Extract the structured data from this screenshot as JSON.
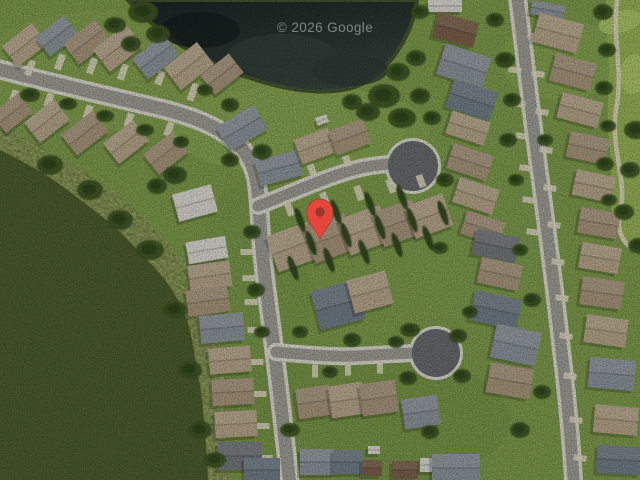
{
  "watermark": {
    "text": "© 2026 Google",
    "color": "#C9CFCE",
    "opacity": 0.55
  },
  "marker": {
    "x": 320,
    "y": 212,
    "body_color": "#E6473D",
    "edge_color": "#B5372C",
    "dot_color": "#9E372B"
  },
  "palette": {
    "grass": "#7C984B",
    "golf": "#93AF55",
    "green_oval": "#A9C368",
    "trail": "#D9D2B8",
    "pond": "#243230",
    "shore": "#43522F",
    "woods": "#4D5A2A",
    "scrub": "#6C7B3A",
    "street": "#9A9A92",
    "curb": "#D6D6CA",
    "culdesac": "#66696B",
    "driveway": "#DBD4BF",
    "tree": "#3C5323",
    "tree_dark": "#2B3E18",
    "cypress": "#2F441C",
    "roof_t": "#B3A287",
    "roof_t2": "#A5937A",
    "roof_g": "#8A9298",
    "roof_g2": "#6F7B85",
    "roof_w": "#D5D4CE",
    "roof_b": "#7A5F4A",
    "roof_gd": "#70767A"
  },
  "scene": {
    "grass_patches": [
      [
        300,
        130,
        130,
        45,
        "#8BA956",
        0.55
      ],
      [
        470,
        200,
        80,
        120,
        "#7E9C4D",
        0.4
      ],
      [
        120,
        70,
        150,
        60,
        "#86A351",
        0.4
      ],
      [
        350,
        420,
        160,
        70,
        "#6F8B42",
        0.45
      ],
      [
        250,
        300,
        60,
        120,
        "#749046",
        0.4
      ],
      [
        560,
        60,
        60,
        40,
        "#88A654",
        0.5
      ]
    ],
    "golf": {
      "area": "M 606 0 L 640 0 L 640 252 C 630 245 620 240 615 225 C 609 205 613 170 609 140 C 605 110 611 75 608 45 C 606 25 606 10 606 0 Z",
      "trail": "M 618 -4 C 611 35 624 70 616 110 C 610 148 628 180 620 215 C 616 235 626 245 636 252",
      "greens": [
        [
          620,
          22,
          22,
          11,
          -15
        ],
        [
          634,
          74,
          14,
          20,
          8
        ]
      ]
    },
    "scrub": "M 0 125 C 35 142 60 158 85 172 C 112 188 130 205 150 225 C 170 245 185 260 196 277 C 207 295 214 312 218 332 C 222 355 224 376 225 400 C 227 430 228 456 228 480 L 0 480 Z",
    "woods": "M 0 150 C 30 165 52 178 70 192 C 95 211 115 226 130 242 C 148 261 163 275 172 290 C 183 308 189 322 192 340 C 197 368 200 384 202 400 C 205 428 207 455 208 480 L 0 480 Z",
    "pond": "M 128 0 C 140 14 160 32 185 48 C 215 66 245 78 278 86 C 305 92 330 94 352 88 C 375 81 392 62 403 42 C 412 26 416 10 417 0 Z",
    "pond_patches": [
      [
        282,
        56,
        55,
        22,
        "#33403B",
        0.85
      ],
      [
        350,
        70,
        38,
        16,
        "#2D3A36",
        0.8
      ],
      [
        200,
        30,
        40,
        18,
        "#141D1B",
        0.7
      ]
    ],
    "streets": [
      {
        "d": "M -6 68 C 40 80 90 92 150 106 C 195 116 230 130 246 154 C 258 172 258 190 260 220 C 262 262 268 300 273 340 C 278 380 284 430 290 486",
        "w": 13
      },
      {
        "d": "M 258 206 C 280 198 310 184 340 174 C 358 168 372 165 390 164",
        "w": 11
      },
      {
        "d": "M 276 352 C 300 354 330 357 355 356 C 375 355 392 354 414 353",
        "w": 11
      },
      {
        "d": "M 517 -6 C 524 50 532 120 541 185 C 549 245 556 300 562 355 C 567 395 571 440 574 486",
        "w": 12
      }
    ],
    "culdesacs": [
      [
        413,
        166,
        25
      ],
      [
        436,
        353,
        24
      ]
    ],
    "driveways": [
      [
        289,
        208,
        7,
        16,
        -20
      ],
      [
        325,
        200,
        7,
        16,
        -20
      ],
      [
        359,
        193,
        7,
        15,
        -20
      ],
      [
        391,
        186,
        7,
        14,
        -20
      ],
      [
        421,
        181,
        7,
        13,
        -20
      ],
      [
        312,
        170,
        7,
        12,
        -20
      ],
      [
        347,
        161,
        7,
        11,
        -20
      ],
      [
        247,
        252,
        13,
        6,
        0
      ],
      [
        249,
        278,
        13,
        6,
        0
      ],
      [
        251,
        302,
        13,
        6,
        0
      ],
      [
        254,
        330,
        13,
        6,
        0
      ],
      [
        257,
        362,
        13,
        6,
        0
      ],
      [
        260,
        394,
        13,
        6,
        0
      ],
      [
        263,
        426,
        13,
        6,
        0
      ],
      [
        266,
        458,
        13,
        6,
        0
      ],
      [
        14,
        96,
        7,
        12,
        20
      ],
      [
        49,
        100,
        7,
        14,
        20
      ],
      [
        88,
        112,
        7,
        14,
        20
      ],
      [
        129,
        120,
        7,
        14,
        20
      ],
      [
        169,
        129,
        7,
        14,
        20
      ],
      [
        30,
        68,
        7,
        16,
        20
      ],
      [
        60,
        62,
        7,
        16,
        20
      ],
      [
        92,
        66,
        7,
        16,
        20
      ],
      [
        123,
        72,
        7,
        16,
        20
      ],
      [
        160,
        78,
        7,
        14,
        20
      ],
      [
        193,
        92,
        7,
        18,
        20
      ],
      [
        515,
        70,
        13,
        6,
        8
      ],
      [
        519,
        104,
        13,
        6,
        8
      ],
      [
        522,
        136,
        13,
        6,
        8
      ],
      [
        526,
        168,
        13,
        6,
        8
      ],
      [
        529,
        200,
        13,
        6,
        8
      ],
      [
        533,
        232,
        13,
        6,
        8
      ],
      [
        534,
        36,
        13,
        6,
        8
      ],
      [
        538,
        74,
        13,
        6,
        8
      ],
      [
        542,
        112,
        13,
        6,
        8
      ],
      [
        546,
        150,
        13,
        6,
        8
      ],
      [
        550,
        188,
        13,
        6,
        8
      ],
      [
        554,
        225,
        13,
        6,
        8
      ],
      [
        558,
        262,
        13,
        6,
        8
      ],
      [
        562,
        298,
        13,
        6,
        8
      ],
      [
        566,
        336,
        13,
        6,
        8
      ],
      [
        570,
        376,
        13,
        6,
        8
      ],
      [
        576,
        420,
        13,
        6,
        8
      ],
      [
        580,
        458,
        13,
        6,
        8
      ],
      [
        315,
        371,
        6,
        13,
        0
      ],
      [
        348,
        369,
        6,
        13,
        0
      ],
      [
        380,
        367,
        6,
        13,
        0
      ]
    ],
    "houses": [
      [
        25,
        45,
        38,
        26,
        -38,
        "t"
      ],
      [
        57,
        36,
        36,
        24,
        -38,
        "g"
      ],
      [
        87,
        42,
        40,
        26,
        -38,
        "t2"
      ],
      [
        118,
        48,
        42,
        28,
        -38,
        "t"
      ],
      [
        156,
        57,
        40,
        26,
        -38,
        "g"
      ],
      [
        189,
        66,
        42,
        28,
        -38,
        "t"
      ],
      [
        222,
        74,
        36,
        24,
        -38,
        "t2"
      ],
      [
        12,
        113,
        34,
        24,
        -38,
        "t2"
      ],
      [
        47,
        121,
        38,
        26,
        -38,
        "t"
      ],
      [
        85,
        133,
        40,
        26,
        -38,
        "t2"
      ],
      [
        126,
        142,
        38,
        26,
        -38,
        "t"
      ],
      [
        166,
        153,
        38,
        26,
        -38,
        "t2"
      ],
      [
        242,
        128,
        44,
        28,
        -30,
        "g"
      ],
      [
        195,
        203,
        40,
        28,
        -15,
        "w"
      ],
      [
        207,
        250,
        40,
        22,
        -10,
        "w"
      ],
      [
        210,
        276,
        42,
        26,
        -8,
        "t"
      ],
      [
        208,
        301,
        42,
        26,
        -8,
        "t2"
      ],
      [
        222,
        328,
        44,
        28,
        -5,
        "g"
      ],
      [
        230,
        360,
        42,
        26,
        -5,
        "t"
      ],
      [
        233,
        392,
        42,
        26,
        -3,
        "t2"
      ],
      [
        236,
        424,
        42,
        26,
        -3,
        "t"
      ],
      [
        240,
        456,
        44,
        28,
        0,
        "gd"
      ],
      [
        279,
        168,
        44,
        26,
        -15,
        "g"
      ],
      [
        315,
        146,
        36,
        26,
        -20,
        "t"
      ],
      [
        350,
        137,
        36,
        26,
        -20,
        "t2"
      ],
      [
        322,
        120,
        12,
        8,
        -20,
        "w"
      ],
      [
        293,
        247,
        44,
        38,
        -20,
        "t"
      ],
      [
        330,
        238,
        44,
        38,
        -20,
        "t2"
      ],
      [
        365,
        230,
        44,
        38,
        -20,
        "t"
      ],
      [
        398,
        223,
        42,
        36,
        -20,
        "t2"
      ],
      [
        429,
        216,
        40,
        34,
        -20,
        "t"
      ],
      [
        445,
        6,
        34,
        12,
        0,
        "w"
      ],
      [
        456,
        30,
        42,
        26,
        15,
        "b"
      ],
      [
        464,
        66,
        48,
        32,
        18,
        "g"
      ],
      [
        472,
        100,
        46,
        30,
        18,
        "g2"
      ],
      [
        468,
        128,
        40,
        24,
        18,
        "t"
      ],
      [
        470,
        162,
        42,
        26,
        18,
        "t2"
      ],
      [
        476,
        196,
        42,
        26,
        18,
        "t"
      ],
      [
        483,
        228,
        40,
        24,
        18,
        "t2"
      ],
      [
        548,
        10,
        34,
        14,
        10,
        "g"
      ],
      [
        558,
        33,
        46,
        30,
        15,
        "t"
      ],
      [
        573,
        72,
        42,
        28,
        15,
        "t2"
      ],
      [
        580,
        110,
        42,
        26,
        15,
        "t"
      ],
      [
        588,
        148,
        40,
        26,
        12,
        "t2"
      ],
      [
        594,
        186,
        40,
        26,
        12,
        "t"
      ],
      [
        599,
        223,
        40,
        26,
        10,
        "t2"
      ],
      [
        600,
        258,
        40,
        26,
        10,
        "t"
      ],
      [
        602,
        293,
        42,
        28,
        8,
        "t2"
      ],
      [
        606,
        331,
        42,
        28,
        8,
        "t"
      ],
      [
        612,
        374,
        46,
        30,
        5,
        "g"
      ],
      [
        616,
        420,
        44,
        28,
        5,
        "t"
      ],
      [
        619,
        460,
        44,
        28,
        3,
        "g2"
      ],
      [
        338,
        305,
        46,
        40,
        -15,
        "g2"
      ],
      [
        370,
        292,
        40,
        34,
        -15,
        "t"
      ],
      [
        496,
        246,
        44,
        26,
        12,
        "gd"
      ],
      [
        500,
        274,
        42,
        26,
        12,
        "t2"
      ],
      [
        496,
        310,
        48,
        30,
        12,
        "g2"
      ],
      [
        516,
        345,
        46,
        34,
        12,
        "g"
      ],
      [
        510,
        381,
        44,
        30,
        10,
        "t2"
      ],
      [
        314,
        402,
        34,
        30,
        -8,
        "t2"
      ],
      [
        347,
        400,
        34,
        32,
        -8,
        "t"
      ],
      [
        379,
        398,
        36,
        32,
        -8,
        "t2"
      ],
      [
        421,
        412,
        36,
        30,
        -8,
        "g"
      ],
      [
        317,
        462,
        34,
        26,
        0,
        "g"
      ],
      [
        348,
        462,
        30,
        24,
        0,
        "g2"
      ],
      [
        372,
        468,
        20,
        16,
        0,
        "b"
      ],
      [
        374,
        450,
        12,
        8,
        0,
        "w"
      ],
      [
        405,
        470,
        26,
        18,
        0,
        "b"
      ],
      [
        429,
        465,
        18,
        14,
        0,
        "w"
      ],
      [
        456,
        468,
        48,
        28,
        0,
        "g"
      ],
      [
        262,
        470,
        36,
        24,
        0,
        "g2"
      ]
    ],
    "trees": [
      [
        143,
        12,
        15,
        11
      ],
      [
        158,
        34,
        12,
        9
      ],
      [
        131,
        44,
        10,
        8
      ],
      [
        115,
        25,
        11,
        8
      ],
      [
        384,
        96,
        16,
        12
      ],
      [
        402,
        118,
        14,
        10
      ],
      [
        368,
        112,
        12,
        9
      ],
      [
        420,
        96,
        10,
        8
      ],
      [
        352,
        102,
        10,
        8
      ],
      [
        398,
        72,
        12,
        9
      ],
      [
        416,
        58,
        10,
        8
      ],
      [
        432,
        118,
        9,
        7
      ],
      [
        30,
        95,
        10,
        7
      ],
      [
        68,
        104,
        9,
        6
      ],
      [
        105,
        116,
        9,
        6
      ],
      [
        145,
        130,
        9,
        6
      ],
      [
        181,
        142,
        8,
        6
      ],
      [
        175,
        175,
        12,
        9
      ],
      [
        157,
        186,
        10,
        8
      ],
      [
        230,
        160,
        9,
        7
      ],
      [
        262,
        152,
        10,
        8
      ],
      [
        252,
        232,
        9,
        7
      ],
      [
        256,
        290,
        9,
        7
      ],
      [
        262,
        332,
        8,
        6
      ],
      [
        603,
        12,
        10,
        8
      ],
      [
        607,
        50,
        9,
        7
      ],
      [
        604,
        88,
        9,
        7
      ],
      [
        608,
        126,
        8,
        6
      ],
      [
        605,
        164,
        9,
        7
      ],
      [
        609,
        200,
        8,
        6
      ],
      [
        636,
        130,
        12,
        9
      ],
      [
        630,
        170,
        10,
        8
      ],
      [
        624,
        212,
        10,
        8
      ],
      [
        638,
        246,
        10,
        8
      ],
      [
        505,
        60,
        10,
        8
      ],
      [
        512,
        100,
        9,
        7
      ],
      [
        508,
        140,
        9,
        7
      ],
      [
        516,
        180,
        8,
        6
      ],
      [
        410,
        330,
        10,
        7
      ],
      [
        458,
        336,
        9,
        7
      ],
      [
        408,
        378,
        9,
        7
      ],
      [
        462,
        376,
        9,
        7
      ],
      [
        290,
        430,
        10,
        7
      ],
      [
        430,
        432,
        9,
        7
      ],
      [
        520,
        430,
        10,
        8
      ],
      [
        542,
        392,
        9,
        7
      ],
      [
        532,
        300,
        9,
        7
      ],
      [
        470,
        312,
        8,
        6
      ],
      [
        352,
        340,
        9,
        7
      ],
      [
        396,
        342,
        8,
        6
      ],
      [
        300,
        332,
        8,
        6
      ],
      [
        330,
        372,
        8,
        6
      ],
      [
        445,
        180,
        9,
        7
      ],
      [
        440,
        248,
        8,
        6
      ],
      [
        520,
        250,
        8,
        6
      ],
      [
        545,
        140,
        8,
        6
      ],
      [
        495,
        20,
        9,
        7
      ],
      [
        420,
        12,
        9,
        7
      ],
      [
        230,
        105,
        9,
        7
      ],
      [
        205,
        90,
        8,
        6
      ],
      [
        150,
        250,
        14,
        10
      ],
      [
        175,
        310,
        12,
        9
      ],
      [
        190,
        370,
        12,
        9
      ],
      [
        200,
        430,
        12,
        9
      ],
      [
        120,
        220,
        13,
        10
      ],
      [
        90,
        190,
        13,
        10
      ],
      [
        50,
        165,
        13,
        10
      ],
      [
        215,
        460,
        11,
        8
      ]
    ],
    "cypresses": [
      [
        311,
        243
      ],
      [
        346,
        235
      ],
      [
        380,
        227
      ],
      [
        412,
        220
      ],
      [
        293,
        268
      ],
      [
        329,
        260
      ],
      [
        364,
        252
      ],
      [
        397,
        245
      ],
      [
        300,
        220
      ],
      [
        336,
        212
      ],
      [
        370,
        204
      ],
      [
        402,
        197
      ],
      [
        443,
        213
      ],
      [
        428,
        238
      ]
    ]
  }
}
